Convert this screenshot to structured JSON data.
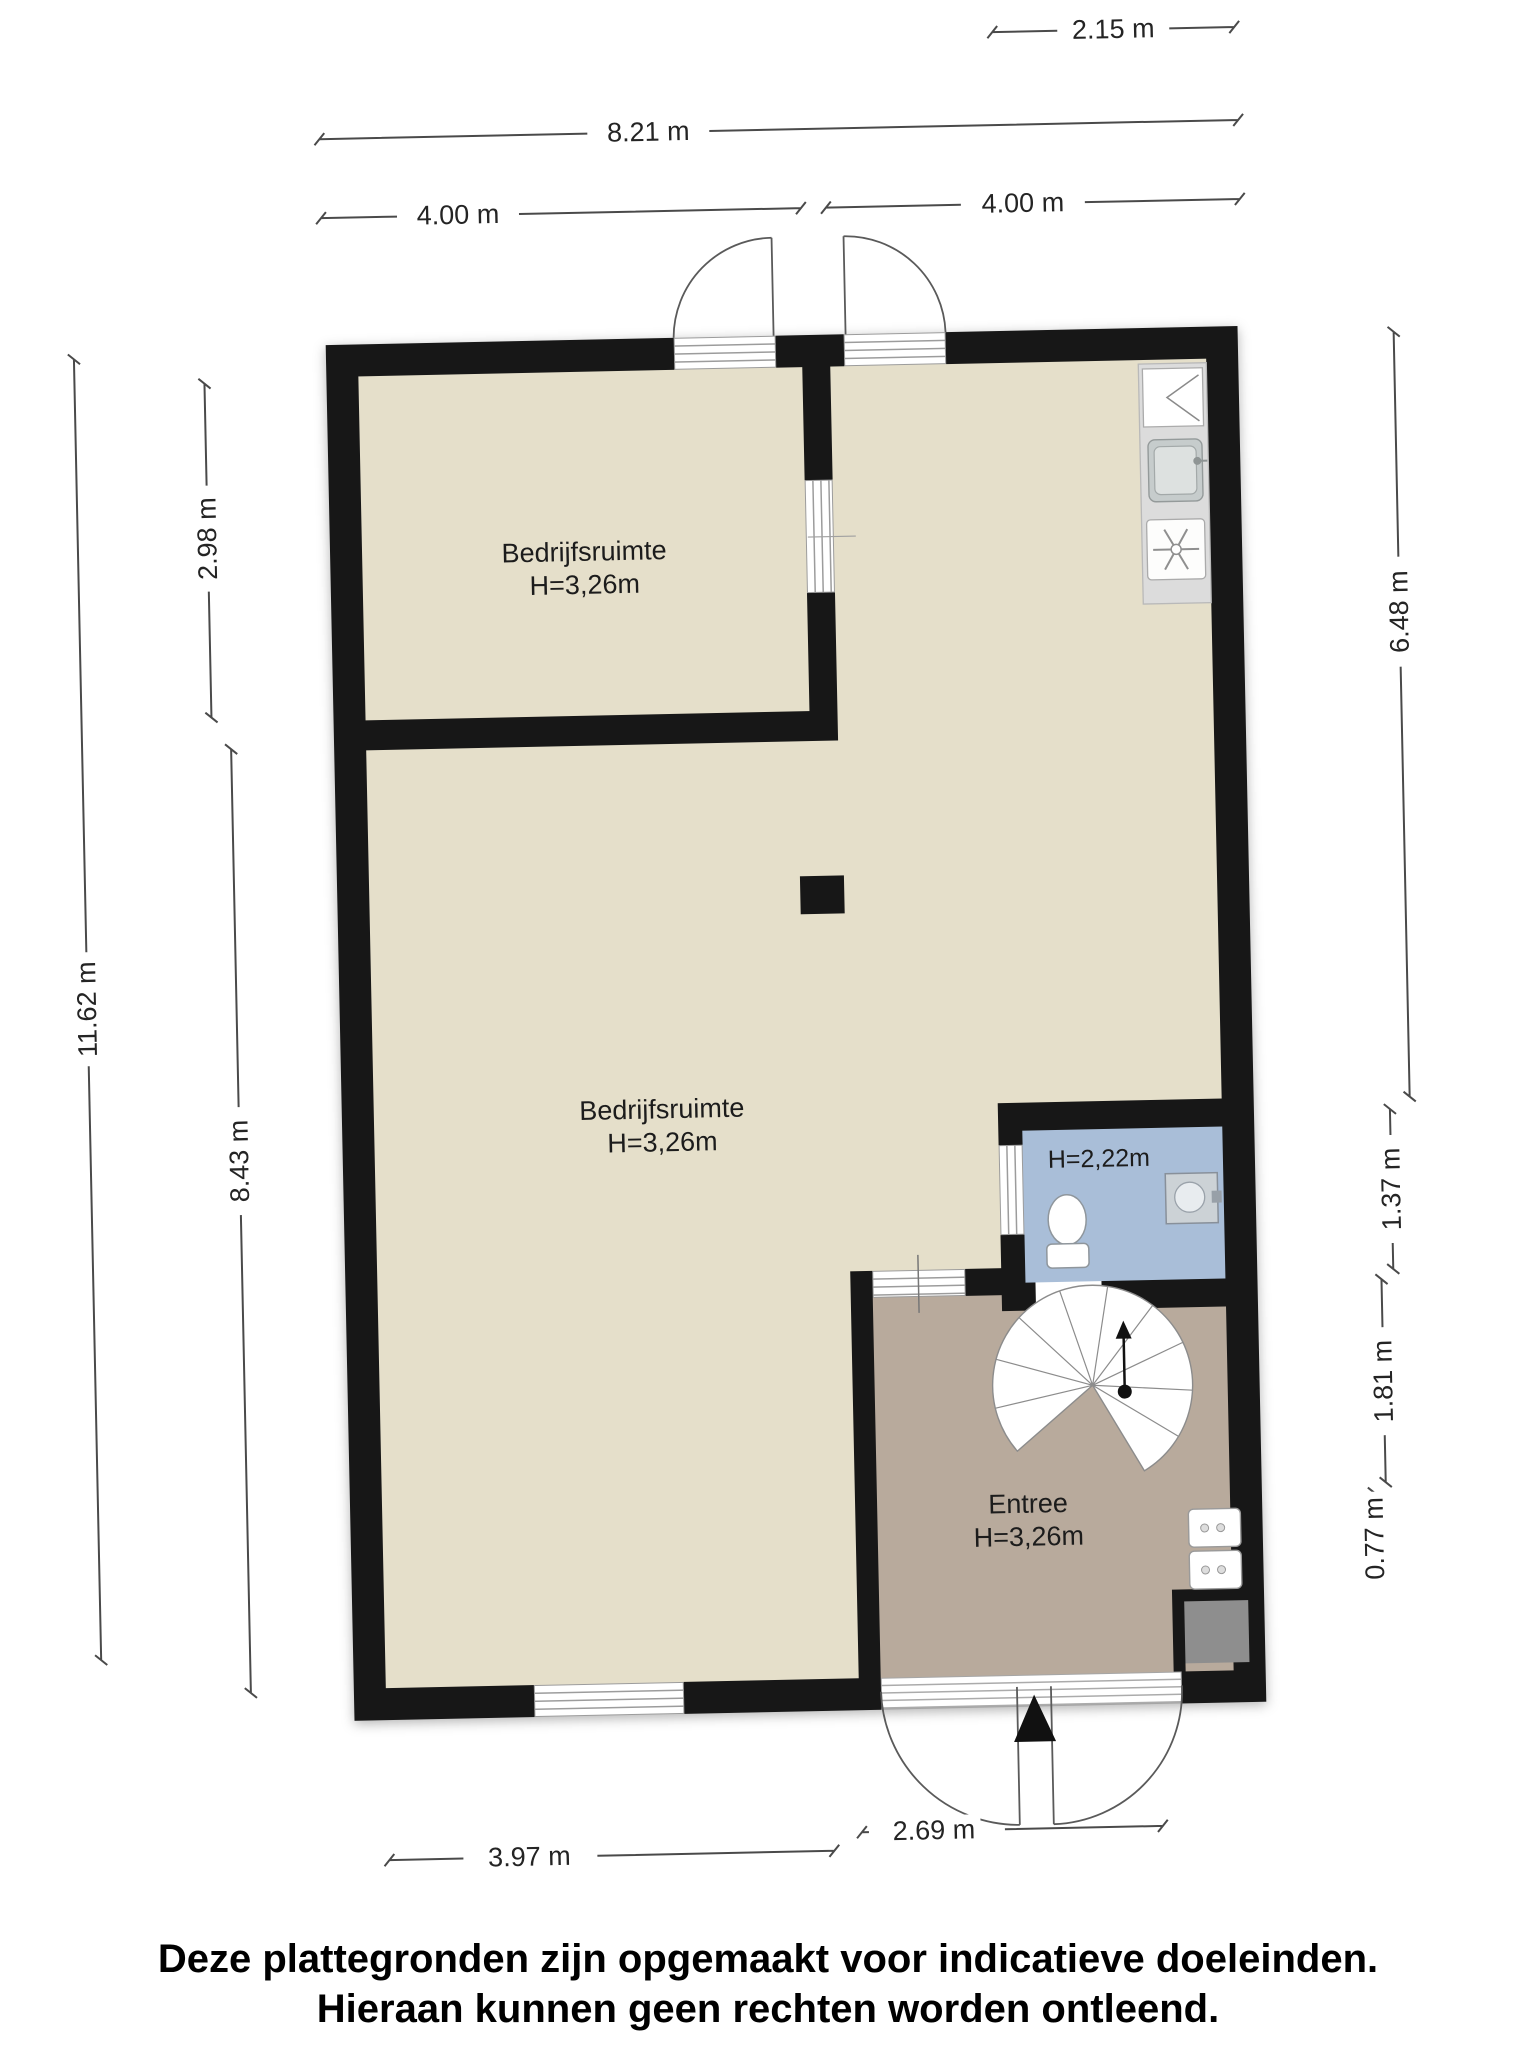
{
  "disclaimer": {
    "line1": "Deze plattegronden zijn opgemaakt voor indicatieve doeleinden.",
    "line2": "Hieraan kunnen geen rechten worden ontleend."
  },
  "rooms": {
    "unit_top": {
      "name": "Bedrijfsruimte",
      "height": "H=3,26m"
    },
    "unit_main": {
      "name": "Bedrijfsruimte",
      "height": "H=3,26m"
    },
    "toilet": {
      "height": "H=2,22m"
    },
    "entree": {
      "name": "Entree",
      "height": "H=3,26m"
    }
  },
  "dimensions": {
    "top_section": "2.15 m",
    "top_total": "8.21 m",
    "top_left_half": "4.00 m",
    "top_right_half": "4.00 m",
    "left_upper_room": "2.98 m",
    "left_total": "11.62 m",
    "left_lower": "8.43 m",
    "right_upper": "6.48 m",
    "right_toilet": "1.37 m",
    "right_hall": "1.81 m",
    "right_porch": "0.77 m",
    "bottom_left": "3.97 m",
    "bottom_entrance": "2.69 m"
  },
  "colors": {
    "wall": "#171717",
    "floor_main": "#E5DFCA",
    "floor_entree": "#B8AA9C",
    "floor_toilet": "#A9BED8",
    "kitchen_counter": "#DCDCDC",
    "dimension_line": "#4A4A4A"
  },
  "fixtures": {
    "spiral_staircase": "spiral-staircase-icon",
    "toilet": "toilet-icon",
    "washbasin": "washbasin-icon",
    "kitchen_sink": "sink-icon",
    "stove": "stove-icon",
    "kitchen_cabinet": "cabinet-icon",
    "column": "column",
    "electrical_panels": "electrical-panel-icon",
    "meter_closet": "meter-closet"
  }
}
